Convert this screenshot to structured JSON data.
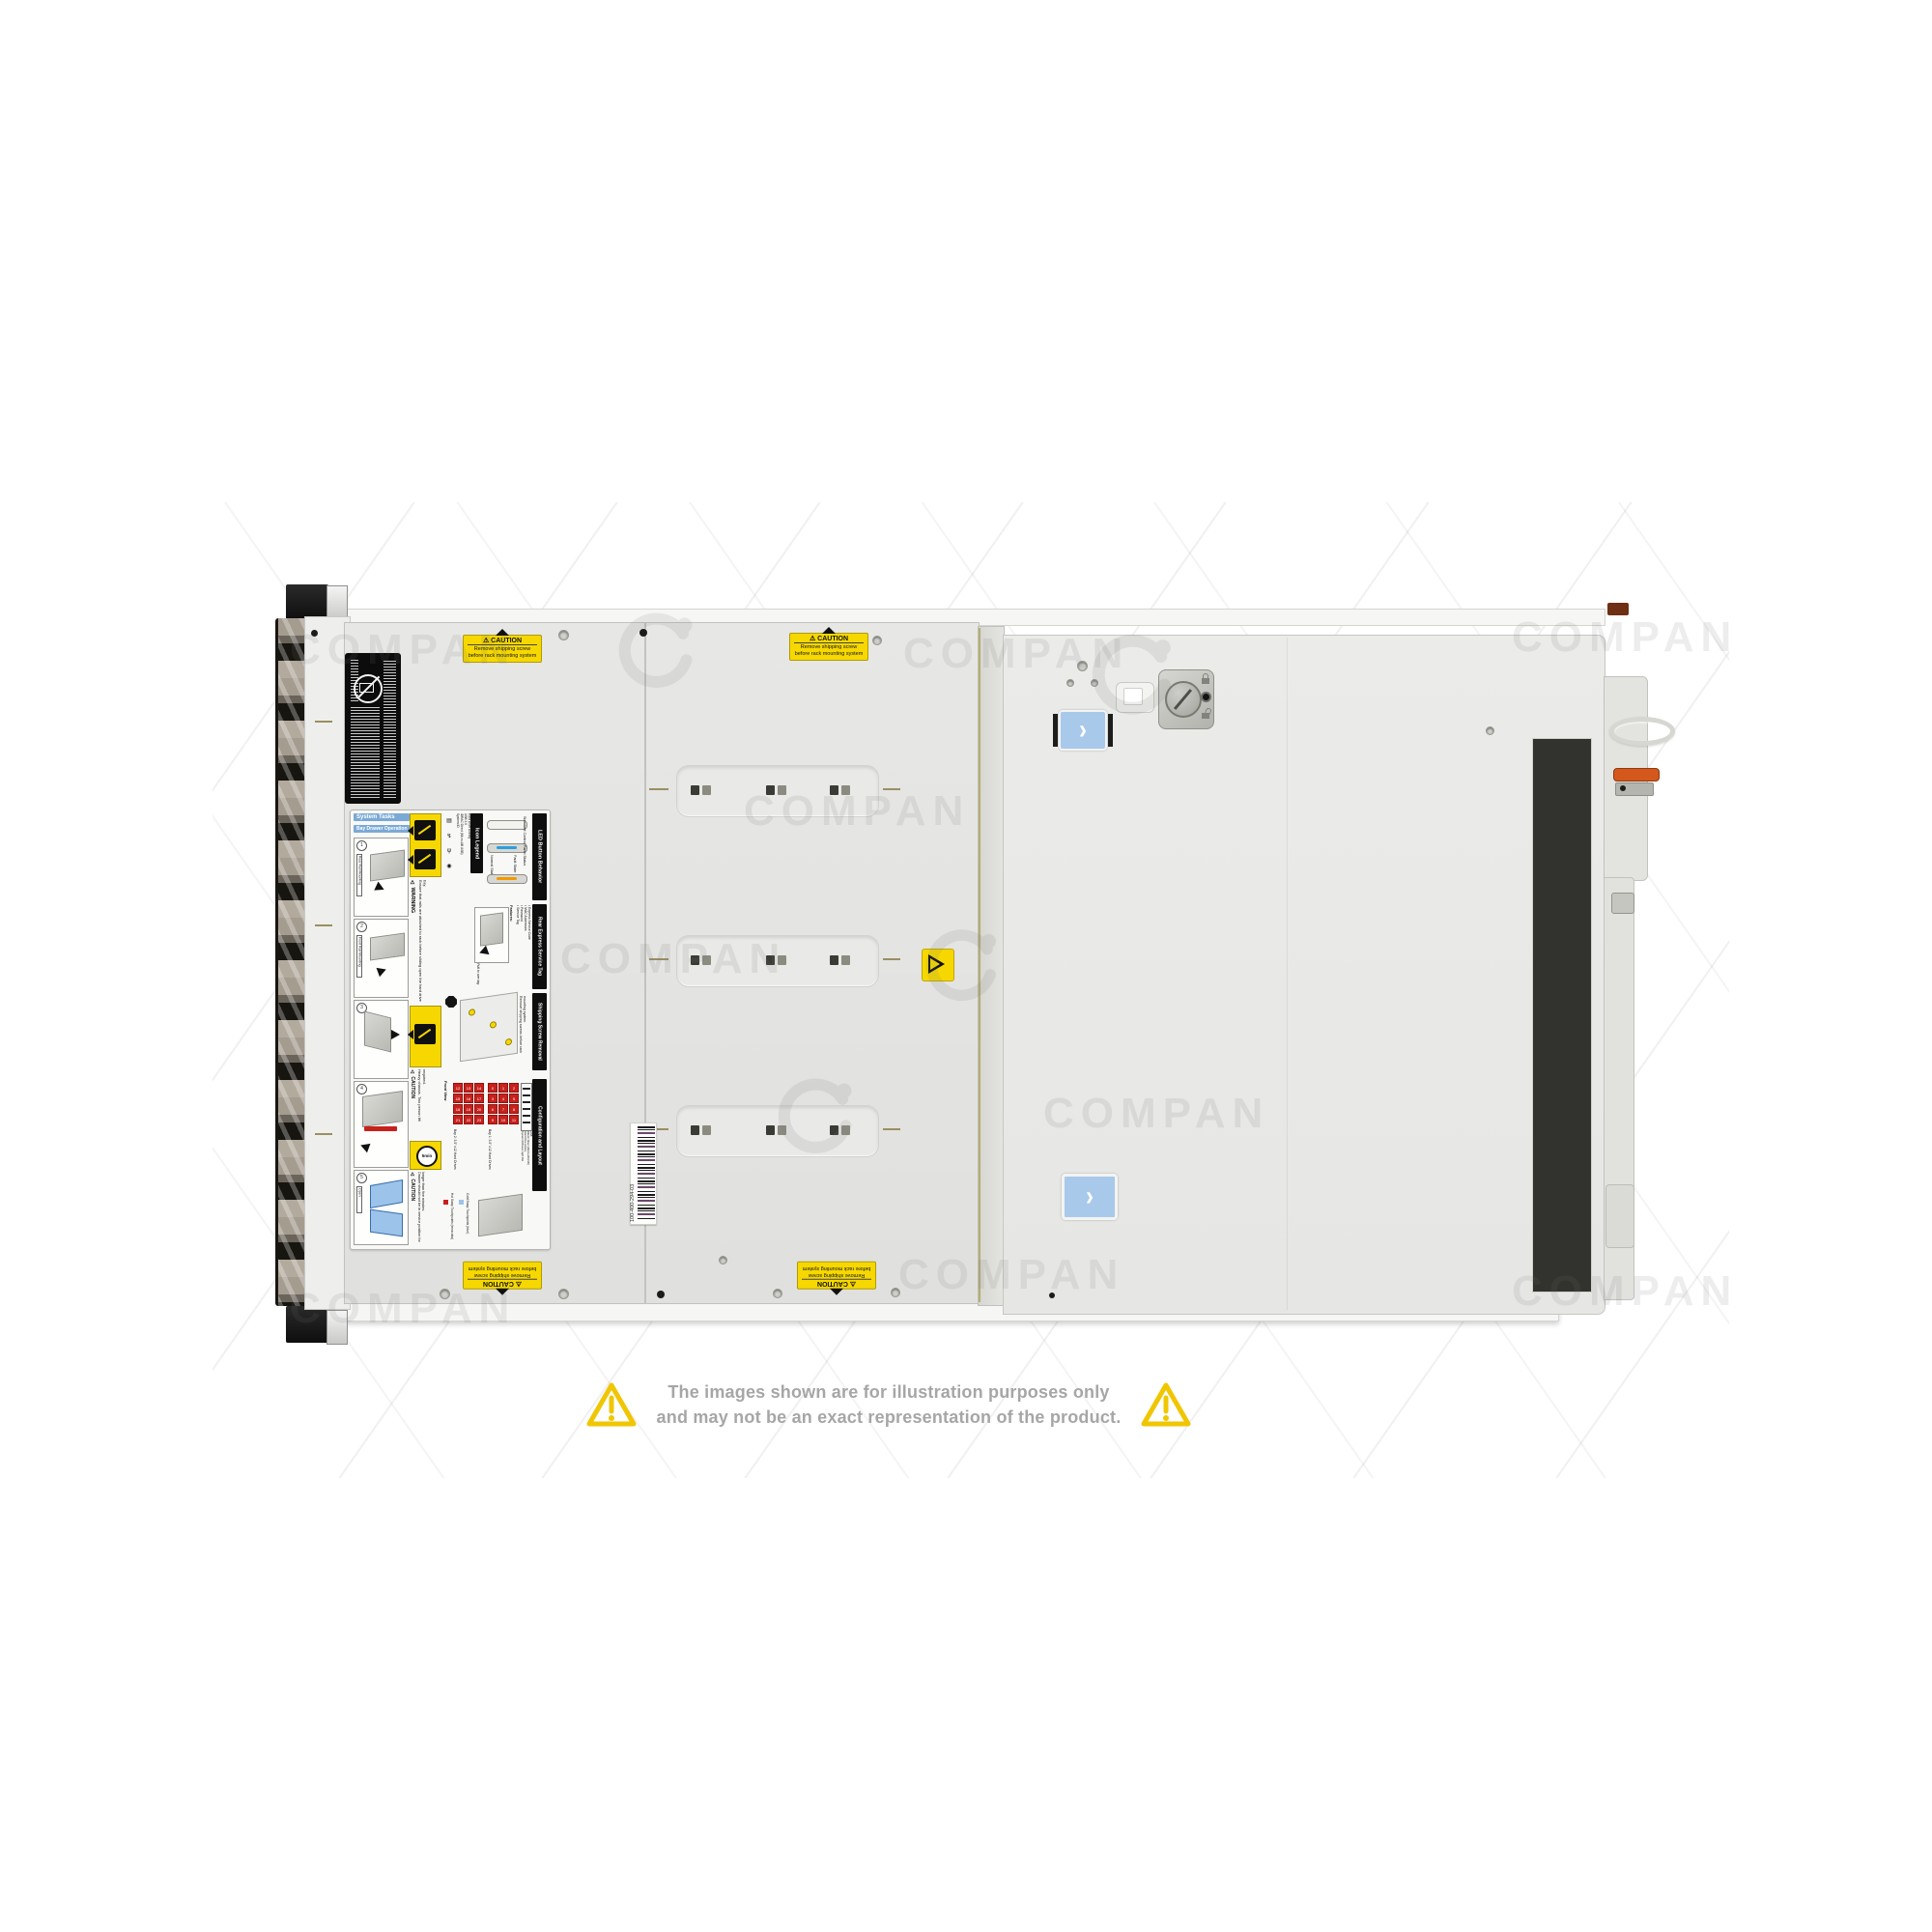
{
  "watermark": {
    "text": "COMPAN"
  },
  "disclaimer": {
    "line1": "The images shown are for illustration purposes only",
    "line2": "and may not be an exact representation of the product."
  },
  "caution": {
    "title": "⚠ CAUTION",
    "line1": "Remove shipping screw",
    "line2": "before rack mounting system"
  },
  "barcode": {
    "text": "100-400-294-03"
  },
  "label": {
    "system_tasks": "System Tasks",
    "bay_drawer_operation": "Bay Drawer Operation",
    "steps": [
      "1",
      "2",
      "3",
      "4",
      "5"
    ],
    "rail_tags": [
      "Rear Rail Mounting",
      "Front Rail Mounting",
      "Open"
    ],
    "warning_title": "⚠ WARNING",
    "warning_text": "Ensure that rails are attached to rack before sliding open the hard drive bay.",
    "icon_legend_title": "Icon Legend",
    "icon_legend_items": [
      "System ID",
      "iDRAC Direct (Micro-AB USB)",
      "USB 2.0",
      "Hard Drive Activity"
    ],
    "led_title": "LED Button Behavior",
    "led_subtitle": "Standard Control Panel Status",
    "led_normal": "Normal State",
    "led_fault": "Fault State",
    "service_title": "Rear Express Service Tag",
    "service_features_heading": "Features:",
    "service_features": [
      "Service Tag",
      "Password",
      "MAC Addresses",
      "Express Service Code"
    ],
    "service_note": "Pull to see tag",
    "shipping_title": "Shipping Screw Removal",
    "shipping_text": "Remove shipping screws before rack mounting system.",
    "caution_heavy_title": "⚠ CAUTION",
    "caution_heavy_text": "Heavy chassis. Two person lift required.",
    "timer": "5min",
    "caution_drawer_title": "⚠ CAUTION",
    "caution_drawer_text": "Drawer should not be in service position for longer than five minutes.",
    "config_title": "Configuration and Layout",
    "config_front_view": "Front View",
    "config_bay1_label": "Bay 1: 3.5\" x12 Hard Drives",
    "config_bay2_label": "Bay 2: 3.5\" x12 Hard Drives",
    "config_bay1": [
      "0",
      "1",
      "2",
      "3",
      "4",
      "5",
      "6",
      "7",
      "8",
      "9",
      "10",
      "11"
    ],
    "config_bay2": [
      "12",
      "13",
      "14",
      "15",
      "16",
      "17",
      "18",
      "19",
      "20",
      "21",
      "22",
      "23"
    ],
    "config_panel_labels": [
      "System ID/Status Light Bar",
      "Hard Drive Activity",
      "iDRAC Direct (Micro-AB USB)",
      "USB",
      "Power"
    ],
    "legend_hot": "Hot Swap Touchpoints (terracotta)",
    "legend_cold": "Cold Swap Touchpoints (blue)"
  },
  "colors": {
    "caution_yellow": "#f6d800",
    "button_blue": "#a9c9eb",
    "latch_orange": "#d4581c",
    "led_blue": "#2a9fe0",
    "led_amber": "#f29a00",
    "bay_red": "#c8201c",
    "legend_blue": "#7aa9d6",
    "legend_cold_blue": "#9cc3ea",
    "warn_triangle": "#f0c602"
  }
}
